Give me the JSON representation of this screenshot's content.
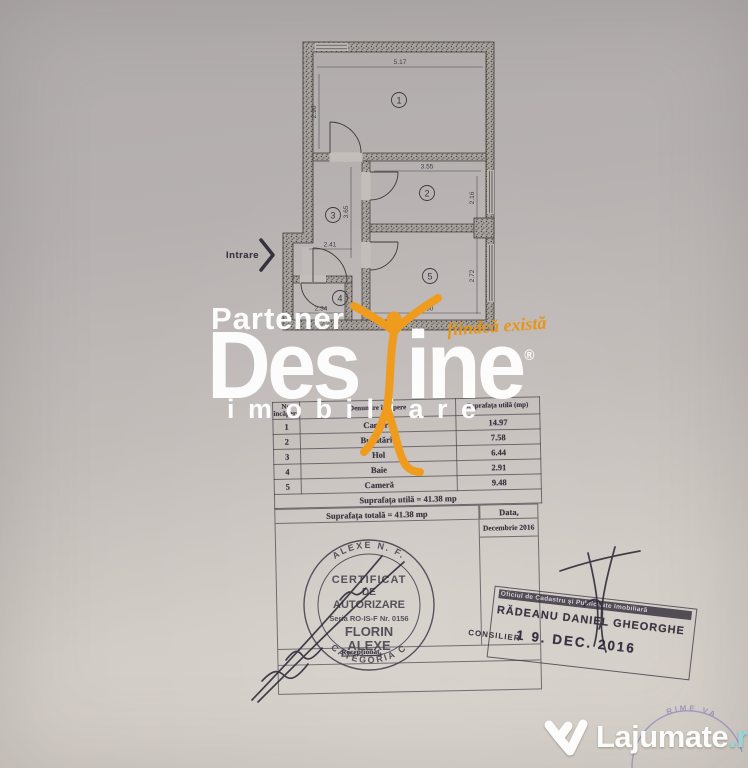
{
  "plan": {
    "entrance_label": "Intrare",
    "room_numbers": [
      "1",
      "2",
      "3",
      "4",
      "5"
    ],
    "dimensions": {
      "room1_width": "5.17",
      "room1_height": "2.90",
      "room2_width": "3.55",
      "room2_height": "2.16",
      "hall_height": "3.65",
      "hall_width": "2.41",
      "room5_height": "2.72",
      "room5_width": "3.50",
      "room4_width": "2.34"
    }
  },
  "watermark": {
    "partener": "Partener",
    "brand_part1": "Des",
    "brand_part2": "ine",
    "registered_mark": "®",
    "slogan": "fiindcă există",
    "imobiliare": "imobiliare",
    "accent_color": "#ef9b1d"
  },
  "area_table": {
    "headers": [
      "Nr. încăpere",
      "Denumire încăpere",
      "Suprafața utilă (mp)"
    ],
    "rows": [
      {
        "nr": "1",
        "name": "Cameră",
        "area": "14.97"
      },
      {
        "nr": "2",
        "name": "Bucătărie",
        "area": "7.58"
      },
      {
        "nr": "3",
        "name": "Hol",
        "area": "6.44"
      },
      {
        "nr": "4",
        "name": "Baie",
        "area": "2.91"
      },
      {
        "nr": "5",
        "name": "Cameră",
        "area": "9.48"
      }
    ],
    "total_utila": "Suprafața utilă = 41.38 mp",
    "total_generala": "Suprafața totală = 41.38 mp"
  },
  "footer": {
    "date_label": "Data,",
    "date_value": "Decembrie 2016",
    "receptionat_label": "Recepționat,",
    "round_stamp": {
      "arc_top": "ALEXE N. F.",
      "line1": "CERTIFICAT",
      "line2": "DE",
      "line3": "AUTORIZARE",
      "serial": "Seria RO-IS-F Nr. 0156",
      "name_line1": "FLORIN",
      "name_line2": "ALEXE",
      "arc_bottom": "CATEGORIA C"
    },
    "cadastre_stamp": {
      "office": "Oficiul de Cadastru și Publicitate Imobiliară",
      "name": "RĂDEANU DANIEL GHEORGHE",
      "role": "CONSILIER",
      "date": "1 9. DEC. 2016"
    }
  },
  "site_watermark": {
    "brand": "Lajumate",
    "tld": ".ro"
  },
  "corner_stamp": {
    "partial_text": "RIME VA"
  }
}
